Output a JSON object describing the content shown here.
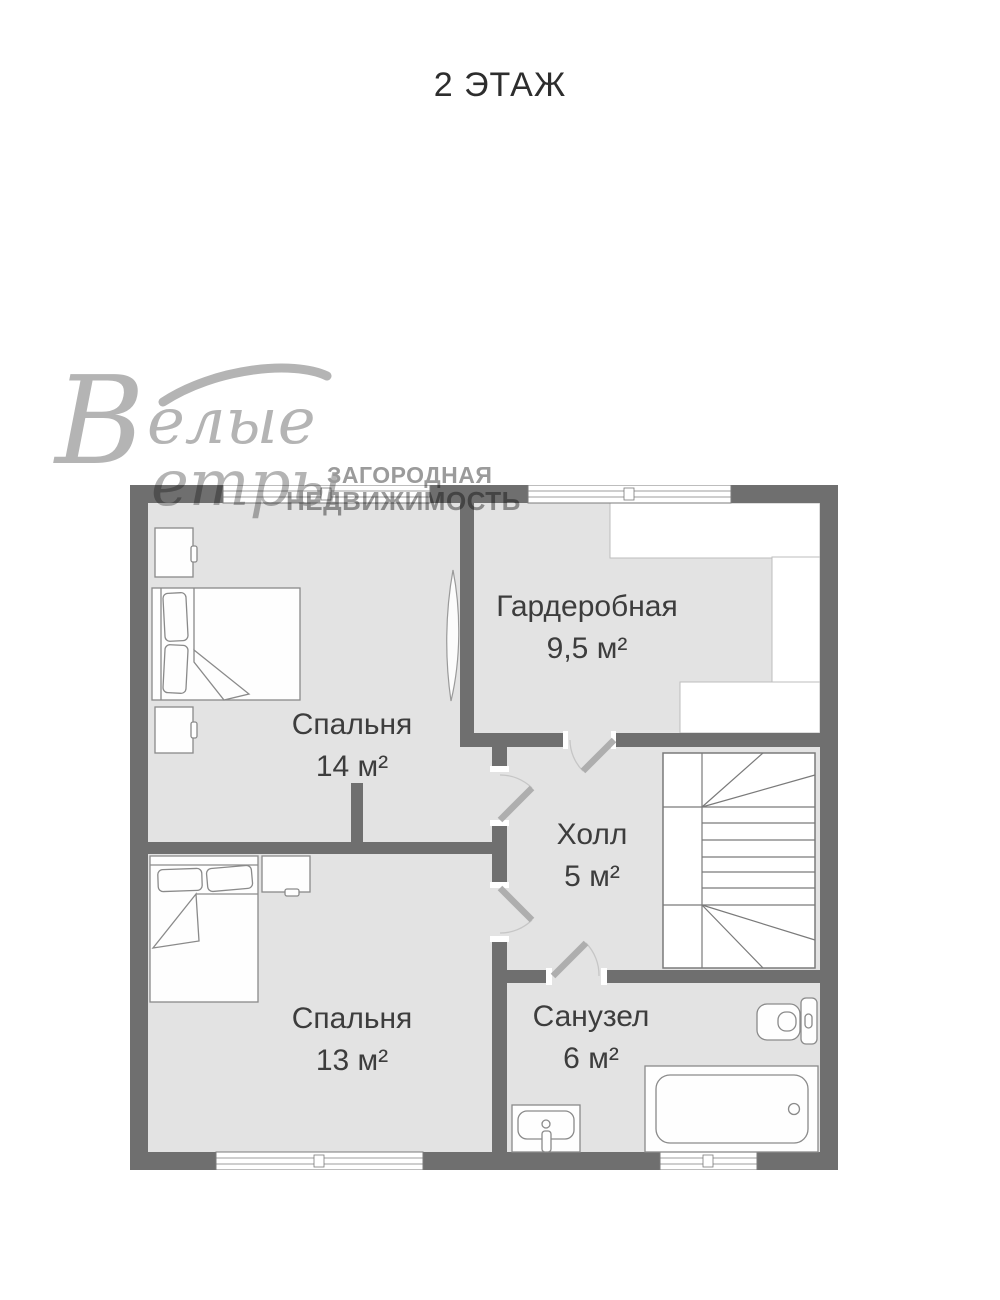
{
  "title": "2 ЭТАЖ",
  "logo": {
    "initial": "В",
    "word1": "елые",
    "word2": "етры",
    "tagline1": "ЗАГОРОДНАЯ",
    "tagline2": "НЕДВИЖИМОСТЬ"
  },
  "rooms": [
    {
      "id": "bedroom-14",
      "name": "Спальня",
      "area": "14 м²"
    },
    {
      "id": "wardrobe",
      "name": "Гардеробная",
      "area": "9,5 м²"
    },
    {
      "id": "hall",
      "name": "Холл",
      "area": "5 м²"
    },
    {
      "id": "bedroom-13",
      "name": "Спальня",
      "area": "13 м²"
    },
    {
      "id": "bathroom",
      "name": "Санузел",
      "area": "6 м²"
    }
  ],
  "colors": {
    "wall": "#6f6f6f",
    "floor": "#e3e3e3",
    "outline": "#8a8a8a",
    "text": "#3d3d3d",
    "logo_script": "#b4b4b4",
    "logo_caps": "#9b9b9b"
  }
}
